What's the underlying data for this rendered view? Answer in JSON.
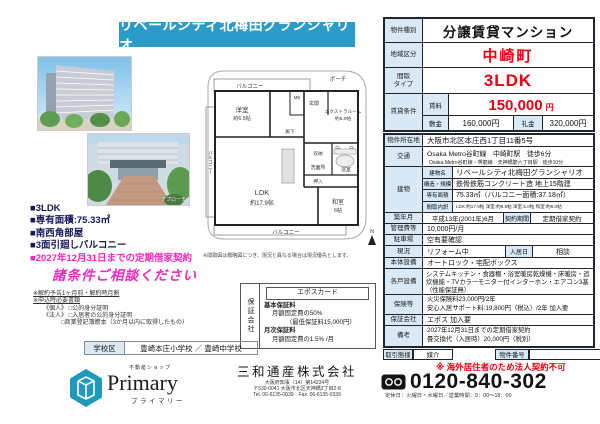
{
  "colors": {
    "banner_teal": "#2b9cc7",
    "highlight_pink": "#ee2bbd",
    "price_red": "#e60012",
    "label_blue": "#d9eaf6",
    "logo_teal": "#1d9abc"
  },
  "banner": {
    "title": "リベールシティ北梅田グランシャリオ"
  },
  "photos": {
    "approach_caption": "アプローチ"
  },
  "floorplan": {
    "note": "※間取図は概略図につき、現況と異なる場合は現況優先とします。",
    "labels": {
      "balcony_top": "バルコニー",
      "porch": "ポーチ",
      "mb": "MB",
      "western_room": "洋室",
      "western_room_size": "約6.5帖",
      "entrance": "玄関",
      "extra_room": "エクストラルーム",
      "extra_room_size": "約5.0帖",
      "hallway": "廊下",
      "storage": "収納",
      "cl1": "CL",
      "cl2": "CL",
      "washroom": "洗面所",
      "bathroom": "浴室",
      "oshiire": "押入",
      "balcony_left": "バルコニー",
      "ldk": "LDK",
      "ldk_size": "約17.9帖",
      "washitsu": "和室",
      "washitsu_size": "6帖",
      "balcony_bottom": "バルコニー",
      "compass": "N"
    }
  },
  "highlights": {
    "items": [
      "■3LDK",
      "■専有面積:75.33㎡",
      "■南西角部屋",
      "■3面引廻しバルコニー"
    ],
    "pink_item": "■2027年12月31日までの定期借家契約",
    "consult": "諸条件ご相談ください"
  },
  "fine_print": {
    "line1": "※解約予告1ヶ月前・解約時月割",
    "line2": "※申込時必要書類",
    "line3": "《個人》 □公的身分証明",
    "line4": "《法人》 □入居者の公的身分証明",
    "line5": "□商業登記簿謄本（3か月以内に取得したもの）"
  },
  "guarantee_box": {
    "side_label": "保証会社",
    "header": "エポスカード",
    "basic_label": "基本保証料",
    "basic_line1": "月額固定費の50%",
    "basic_line2": "（最低保証料15,000円）",
    "monthly_label": "月次保証料",
    "monthly_line1": "月額固定費の1.5% /月"
  },
  "school": {
    "label": "学校区",
    "value": "豊崎本庄小学校 ／ 豊崎中学校"
  },
  "shop_logo": {
    "tagline": "不動産ショップ",
    "name": "Primary",
    "kana": "プライマリー"
  },
  "company": {
    "name": "三和通産株式会社",
    "license": "大阪府知事（14）第14234号",
    "address": "〒530-0041 大阪市北区天神橋3丁目2-8",
    "tel_fax": "Tel. 06-6135-0039　Fax. 06-6135-0339"
  },
  "spec": {
    "property_type": {
      "label": "物件種別",
      "value": "分譲賃貸マンション"
    },
    "area": {
      "label": "地域区分",
      "value": "中崎町"
    },
    "layout": {
      "label_line1": "間取",
      "label_line2": "タイプ",
      "value": "3LDK"
    },
    "rent": {
      "label": "賃貸条件",
      "rent_label": "賃料",
      "rent_value": "150,000",
      "rent_unit": "円",
      "deposit_label": "敷金",
      "deposit_value": "160,000円",
      "key_label": "礼金",
      "key_value": "320,000円"
    },
    "address": {
      "label": "物件所在地",
      "value": "大阪市北区本庄西1丁目11番5号"
    },
    "access": {
      "label": "交通",
      "line1": "Osaka Metro谷町線　中崎町駅　徒歩6分",
      "line2": "Osaka Metro谷町線・堺筋線　天神橋筋六丁目駅　徒歩10分"
    },
    "building": {
      "label": "建物",
      "name_label": "建物名",
      "name_value": "リベールシティ北梅田グランシャリオ",
      "structure_label": "構造・規模",
      "structure_value": "鉄骨鉄筋コンクリート造 地上15階建",
      "size_label": "専有面積",
      "size_value": "75.33㎡（バルコニー面積:37.18㎡）",
      "rooms_label": "間取内訳",
      "rooms_value": "LDK:約17.9帖 洋室:約6.5帖 洋室:5.0帖 和室:約6.0帖"
    },
    "built": {
      "label": "築年月",
      "value": "平成13年(2001年)6月",
      "term_label": "契約期間",
      "term_value": "定期借家契約"
    },
    "mgmt_fee": {
      "label": "管理費等",
      "value": "10,000円/月"
    },
    "parking": {
      "label": "駐車場",
      "value": "空有要確認"
    },
    "condition": {
      "label": "現況",
      "value": "リフォーム中",
      "movein_label": "入居日",
      "movein_value": "相談"
    },
    "base_equipment": {
      "label": "本体設備",
      "value": "オートロック・宅配ボックス"
    },
    "unit_equipment": {
      "label": "各戸設備",
      "value": "システムキッチン・食器棚・浴室暖房乾燥機・床暖房・追炊機能・TVカラーモニター付インターホン・エアコン3基（性能保証無）"
    },
    "insurance": {
      "label": "保険等",
      "line1": "火災保険料23,000円/2年",
      "line2": "安心入居サポート料:19,800円（税込）/2年 加入要"
    },
    "guarantor": {
      "label": "保証会社",
      "value": "エポス 加入要"
    },
    "remarks": {
      "label": "備考",
      "line1": "2027年12月31日までの定期借家契約",
      "line2": "畳交換代（入居時）20,000円（税別）"
    }
  },
  "footer_right": {
    "deal_label": "取引態様",
    "deal_value": "媒介",
    "number_label": "物件番号",
    "number_value": "",
    "red_note": "※ 海外居住者のため法人契約不可",
    "phone": "0120-840-302",
    "hours": "定休日：火曜日・水曜日／営業時間：9：00～18：00"
  }
}
